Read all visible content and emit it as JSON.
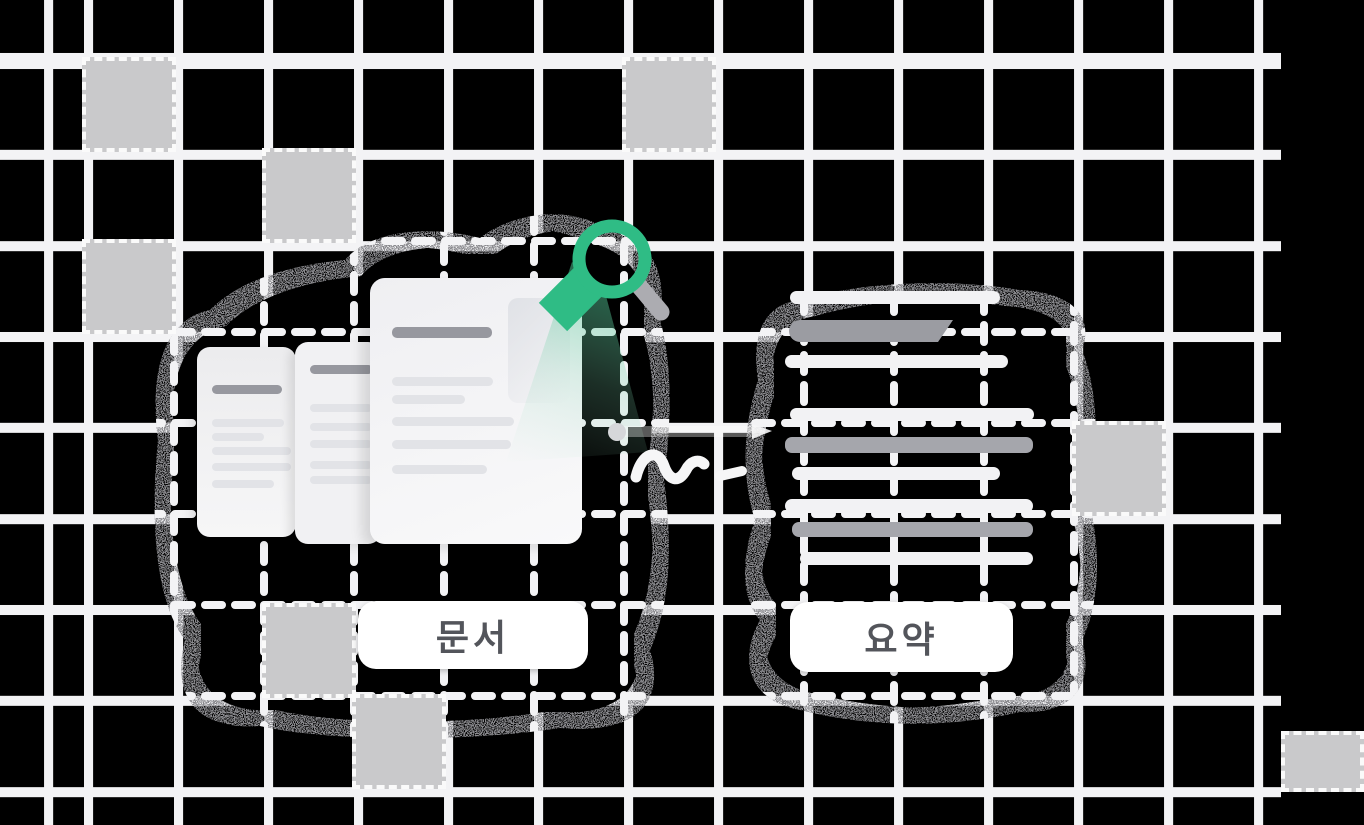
{
  "illustration": {
    "left_label": "문서",
    "right_label": "요약",
    "theme": {
      "background": "#000000",
      "grid_line": "#F3F3F5",
      "grid_square": "#C9C9CB",
      "accent_green": "#2FBC85",
      "pill_background": "#FFFFFF",
      "pill_text": "#53555B",
      "document_background": "#F1F1F3",
      "document_line_light": "#E2E3E7",
      "document_line_dark": "#97989F",
      "summary_line_light": "#F2F2F4",
      "summary_line_dark": "#A5A6AC"
    },
    "icons": [
      "magnifier-icon",
      "arrow-squiggle-icon"
    ]
  }
}
